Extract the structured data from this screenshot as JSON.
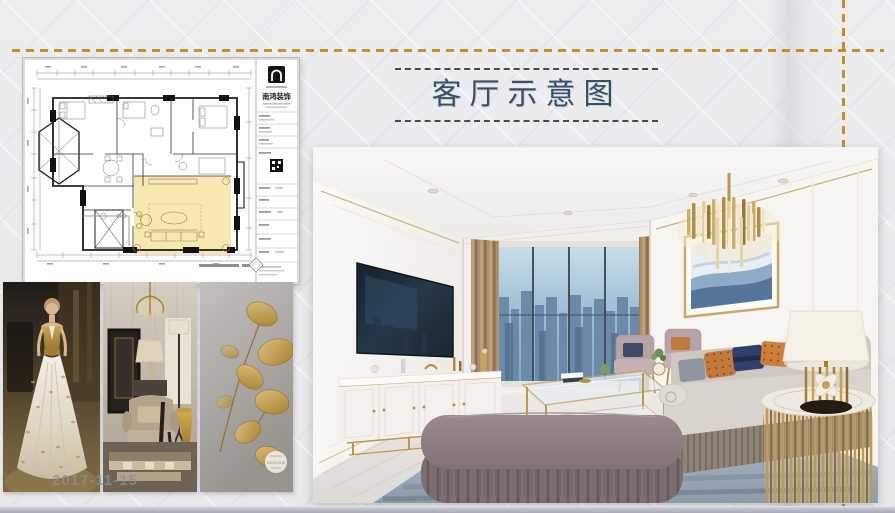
{
  "slide": {
    "title": "客厅示意图",
    "colors": {
      "background": "#ecebee",
      "accent_gold": "#bf9222",
      "title_text": "#3a5068",
      "title_dash": "#4a4a4a",
      "bottom_strip": "#a9a9b6",
      "plan_highlight": "#f6e5aa"
    }
  },
  "floor_plan": {
    "firm_name": "南鸿装饰"
  },
  "mood_board": {
    "date_watermark": "2017-11-15",
    "badge_watermark": "DESIGN",
    "items": [
      {
        "label": "fashion model in white-gold gown"
      },
      {
        "label": "classic interior with gold accents"
      },
      {
        "label": "gold leaf artwork"
      }
    ]
  },
  "rendering": {
    "label": "living room 3D rendering"
  }
}
